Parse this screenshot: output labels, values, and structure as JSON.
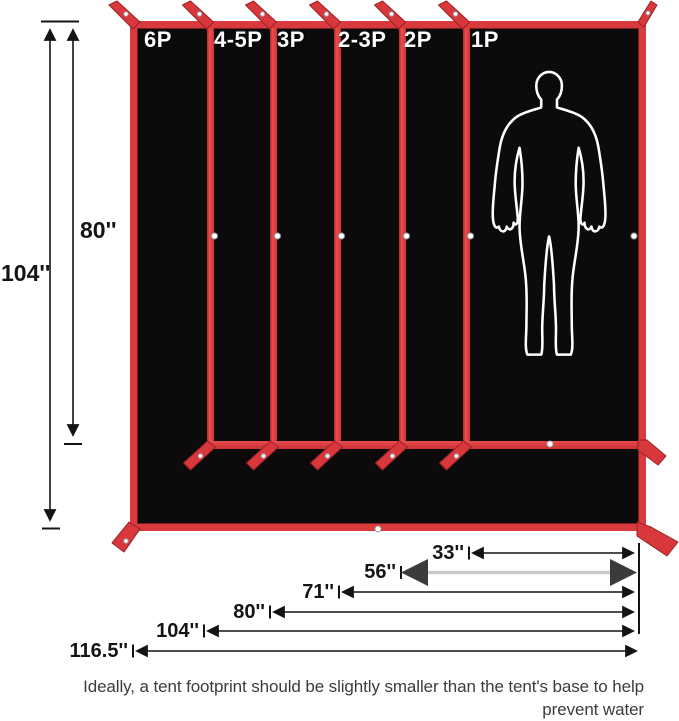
{
  "diagram": {
    "panel_labels": [
      "6P",
      "4-5P",
      "3P",
      "2-3P",
      "2P",
      "1P"
    ],
    "height_dimensions": {
      "outer": "104''",
      "inner": "80''"
    },
    "width_dimensions": [
      "33''",
      "56''",
      "71''",
      "80''",
      "104''",
      "116.5''"
    ],
    "caption_line1": "Ideally, a tent footprint should be slightly smaller than the tent's base to help prevent water",
    "caption_line2": "pooling between the tent and the footprint during wet weather.",
    "colors": {
      "tarp_red": "#d83a3d",
      "tarp_black": "#0c0a0b",
      "dimension_ink": "#141414",
      "gray_arrow": "#c9c9c9",
      "caption_text": "#3c3c3c",
      "silhouette": "#ffffff"
    }
  }
}
